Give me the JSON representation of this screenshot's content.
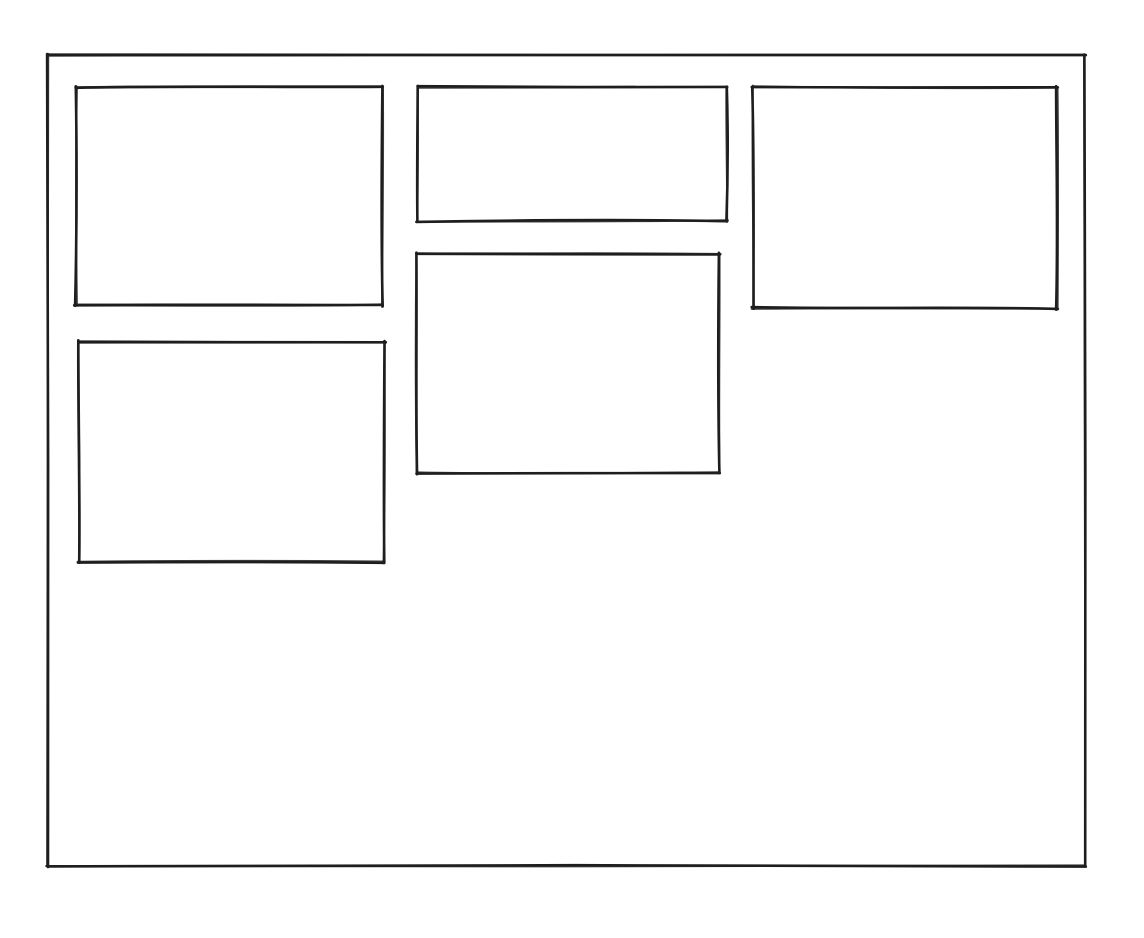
{
  "meta": {
    "description": "hand-drawn wireframe sketch of a page layout",
    "background_color": "#ffffff",
    "stroke_color": "#1e1e1e",
    "stroke_width": 4.2
  },
  "canvas": {
    "width": 1144,
    "height": 938
  },
  "sketch": {
    "frame": {
      "name": "outer-frame",
      "x": 48,
      "y": 55,
      "w": 1037,
      "h": 811
    },
    "panels": [
      {
        "name": "panel-top-left",
        "x": 76,
        "y": 87,
        "w": 306,
        "h": 218
      },
      {
        "name": "panel-top-center",
        "x": 418,
        "y": 87,
        "w": 309,
        "h": 134
      },
      {
        "name": "panel-top-right",
        "x": 753,
        "y": 87,
        "w": 304,
        "h": 221
      },
      {
        "name": "panel-middle-center",
        "x": 417,
        "y": 254,
        "w": 302,
        "h": 219
      },
      {
        "name": "panel-middle-left",
        "x": 79,
        "y": 342,
        "w": 305,
        "h": 220
      }
    ]
  }
}
